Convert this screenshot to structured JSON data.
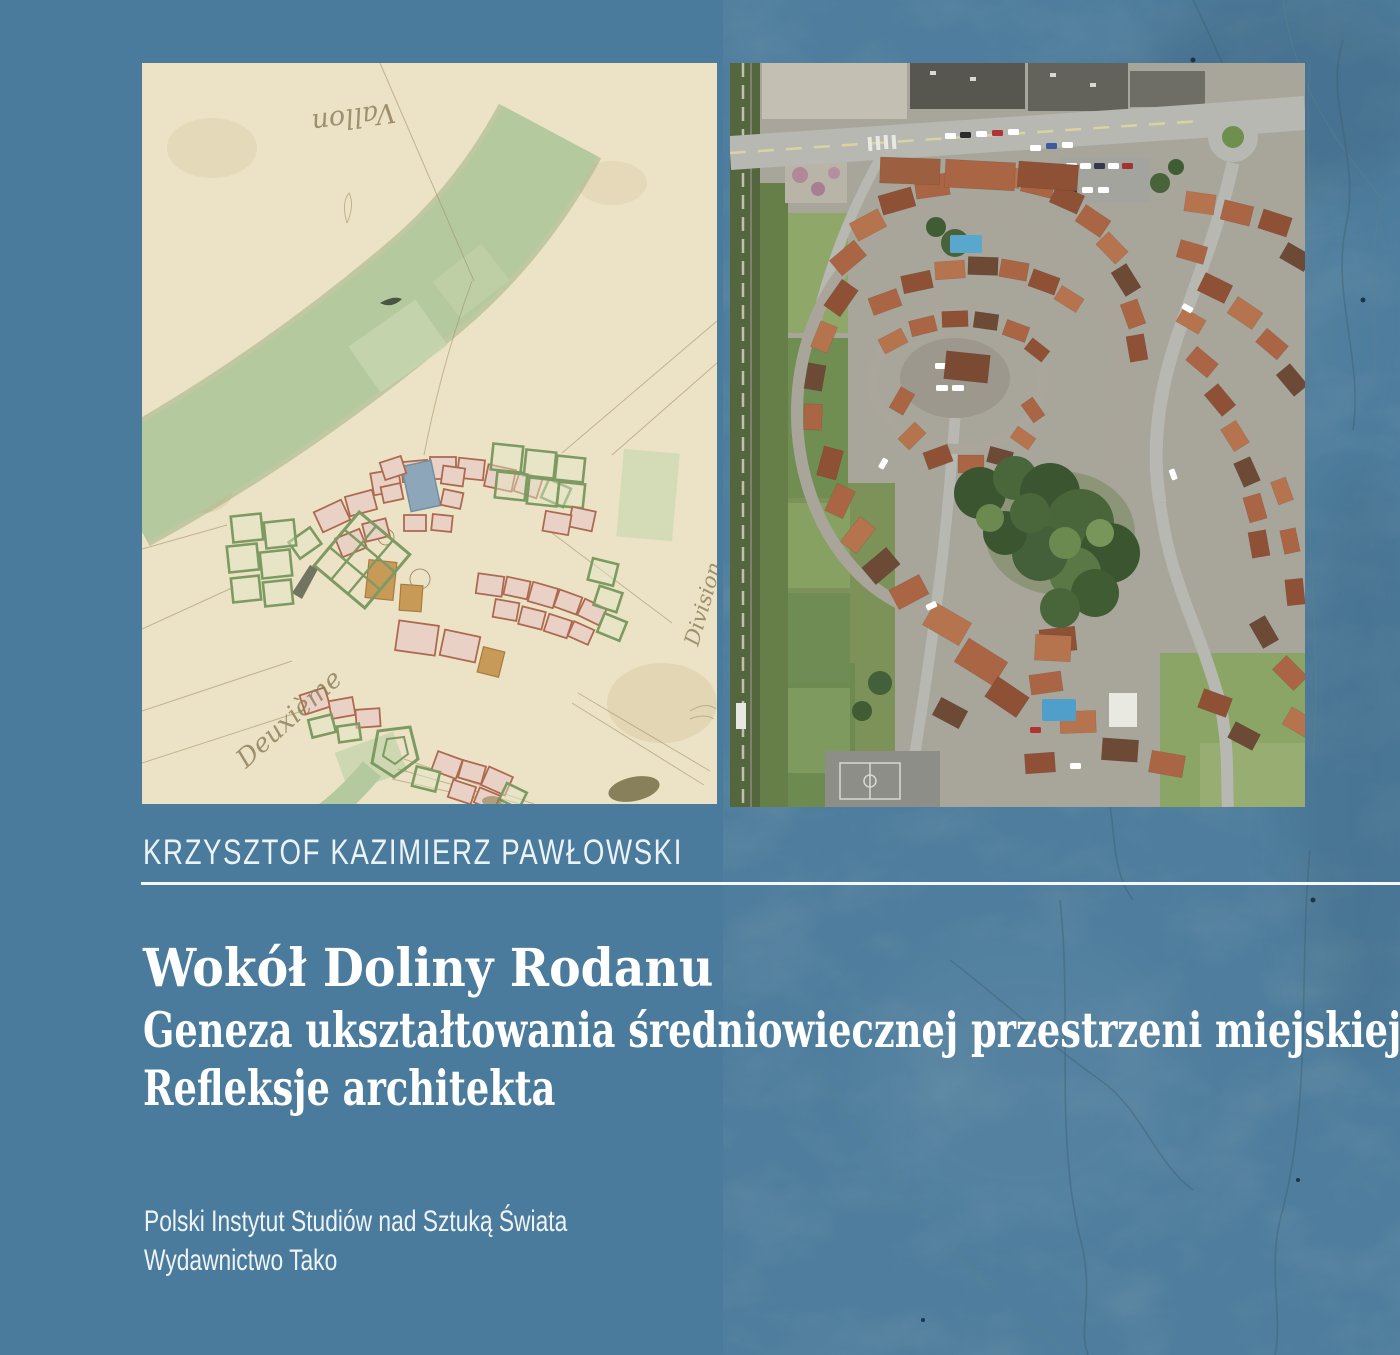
{
  "cover": {
    "author": "KRZYSZTOF KAZIMIERZ PAWŁOWSKI",
    "title": "Wokół Doliny Rodanu",
    "subtitle_line1": "Geneza ukształtowania średniowiecznej przestrzeni miejskiej",
    "subtitle_line2": "Refleksje architekta",
    "publisher_line1": "Polski Instytut Studiów nad Sztuką Świata",
    "publisher_line2": "Wydawnictwo Tako"
  },
  "map_annotations": {
    "top_inverted": "Vallon",
    "bottom_left": "Deuxième",
    "right_side": "Division"
  },
  "colors": {
    "background_blue": "#4b7b9c",
    "marble_base": "#4e7d9d",
    "marble_vein": "#3e5f6e",
    "rule_white": "#f4f8fa",
    "text_white": "#ffffff",
    "map_paper": "#ece3c6",
    "map_green_wash": "#b5c99e",
    "parcel_pink": "#e9d2c5",
    "parcel_outline_red": "#ad6a52",
    "parcel_outline_green": "#7e9a63",
    "roof_terracotta": "#a96544",
    "aerial_street_gray": "#b7b8b1",
    "tree_green": "#3f5c33",
    "pool_blue": "#4f9fca"
  }
}
